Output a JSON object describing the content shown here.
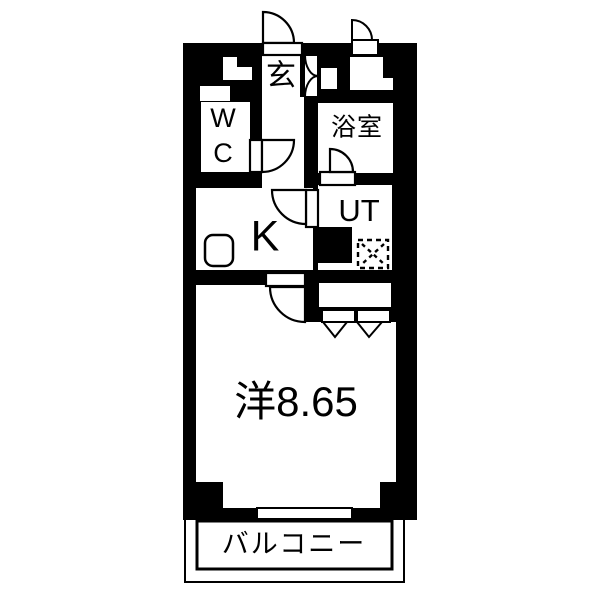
{
  "floorplan": {
    "labels": {
      "entrance": "玄",
      "wc": "WC",
      "bath": "浴室",
      "kitchen": "K",
      "utility": "UT",
      "western_room": "洋8.65",
      "balcony": "バルコニー"
    },
    "colors": {
      "wall": "#000000",
      "floor": "#ffffff"
    }
  }
}
